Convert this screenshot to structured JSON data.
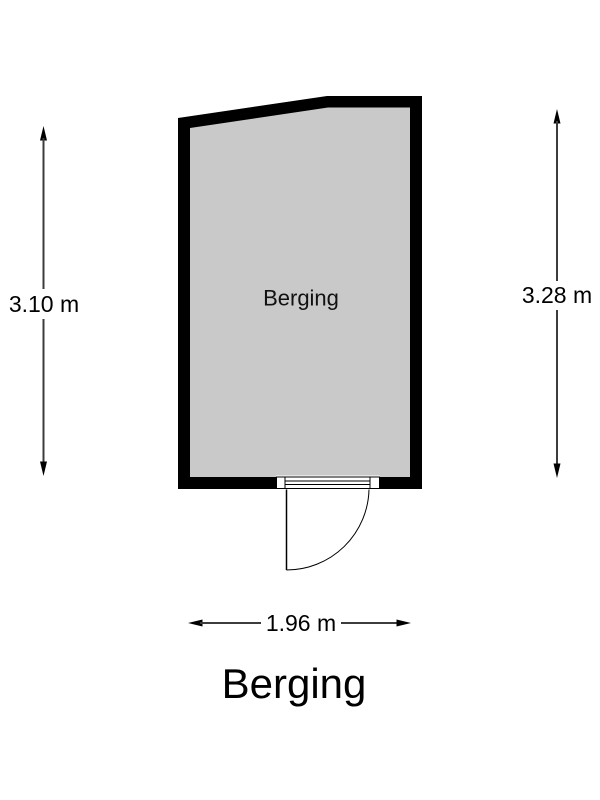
{
  "floorplan": {
    "title": "Berging",
    "room_label": "Berging",
    "dimensions": {
      "left": "3.10 m",
      "right": "3.28 m",
      "bottom": "1.96 m"
    },
    "colors": {
      "wall": "#000000",
      "floor": "#c9c9c9",
      "background": "#ffffff",
      "dimension_line": "#3c3c3c",
      "text": "#000000"
    }
  }
}
